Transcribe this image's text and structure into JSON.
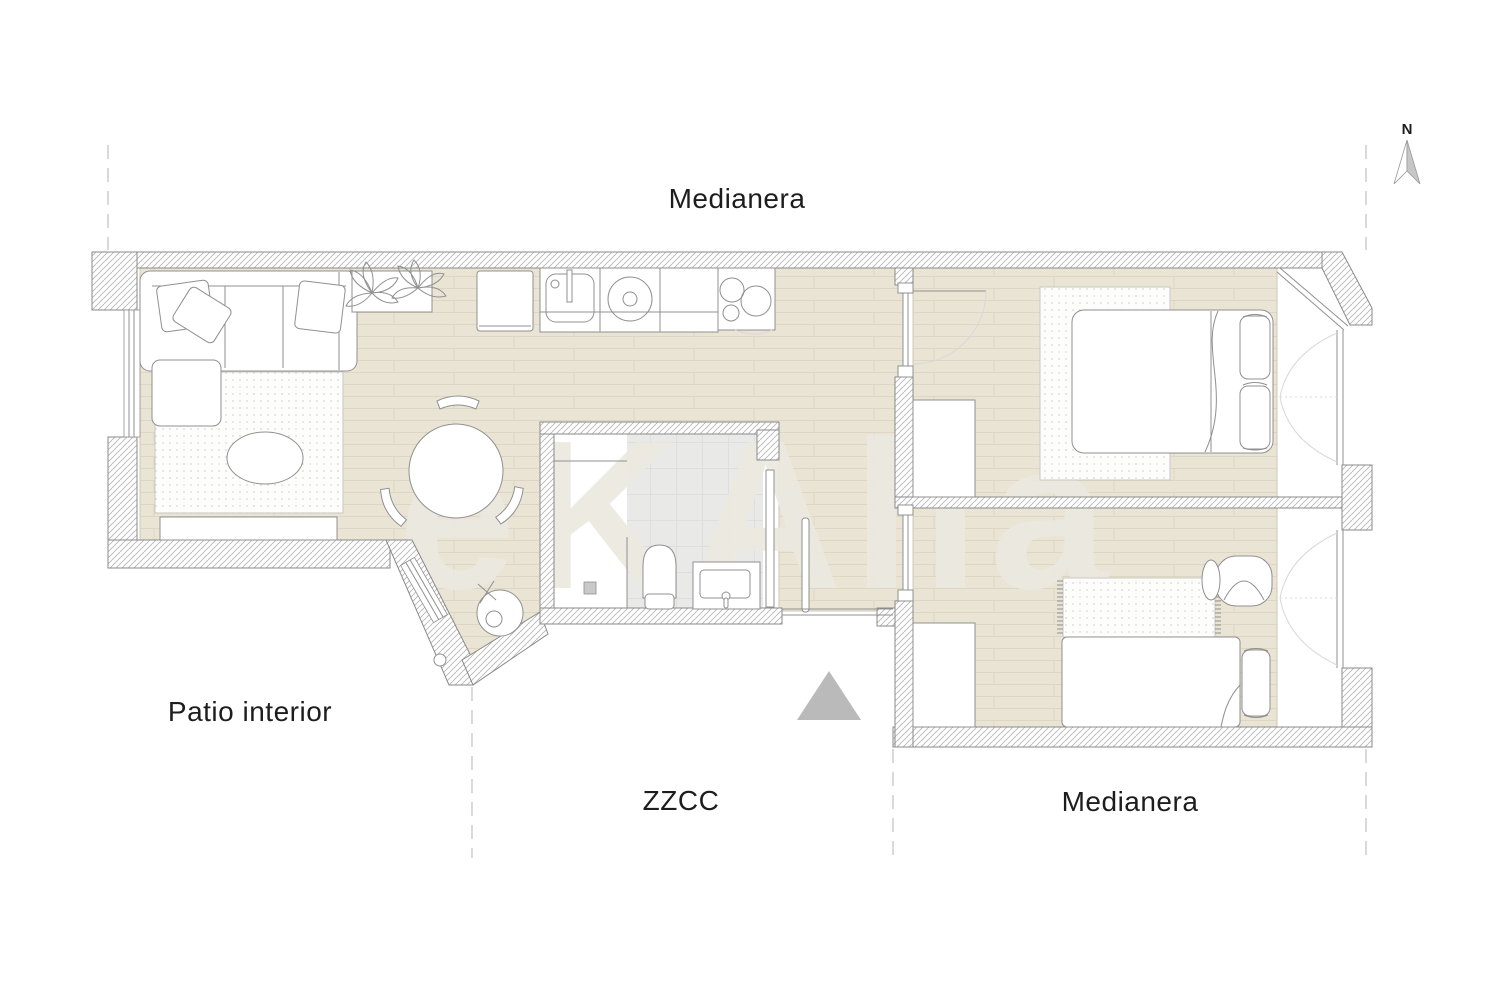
{
  "plan": {
    "labels": {
      "party_wall_top": "Medianera",
      "party_wall_bottom": "Medianera",
      "courtyard": "Patio interior",
      "common_zones": "ZZCC"
    },
    "watermark": "eKAlia",
    "north": {
      "label": "N"
    },
    "colors": {
      "floor": "#eae4d5",
      "floor_line": "#ddd6c4",
      "floor_edge": "#cfc8b8",
      "wall_hatch": "#b5b5b5",
      "wall_outline": "#8a8a8a",
      "furniture_stroke": "#909090",
      "bath_floor": "#e9e9e8",
      "bath_tile_line": "#dedede",
      "rug_fill": "#fdfdfc",
      "rug_dot": "#d7d7d3",
      "accent_triangle": "#bababa",
      "dashed_line": "#d0d0d0",
      "text": "#1d1d1d",
      "watermark": "#ece9e0",
      "north_fill": "#c6c6c6"
    }
  }
}
